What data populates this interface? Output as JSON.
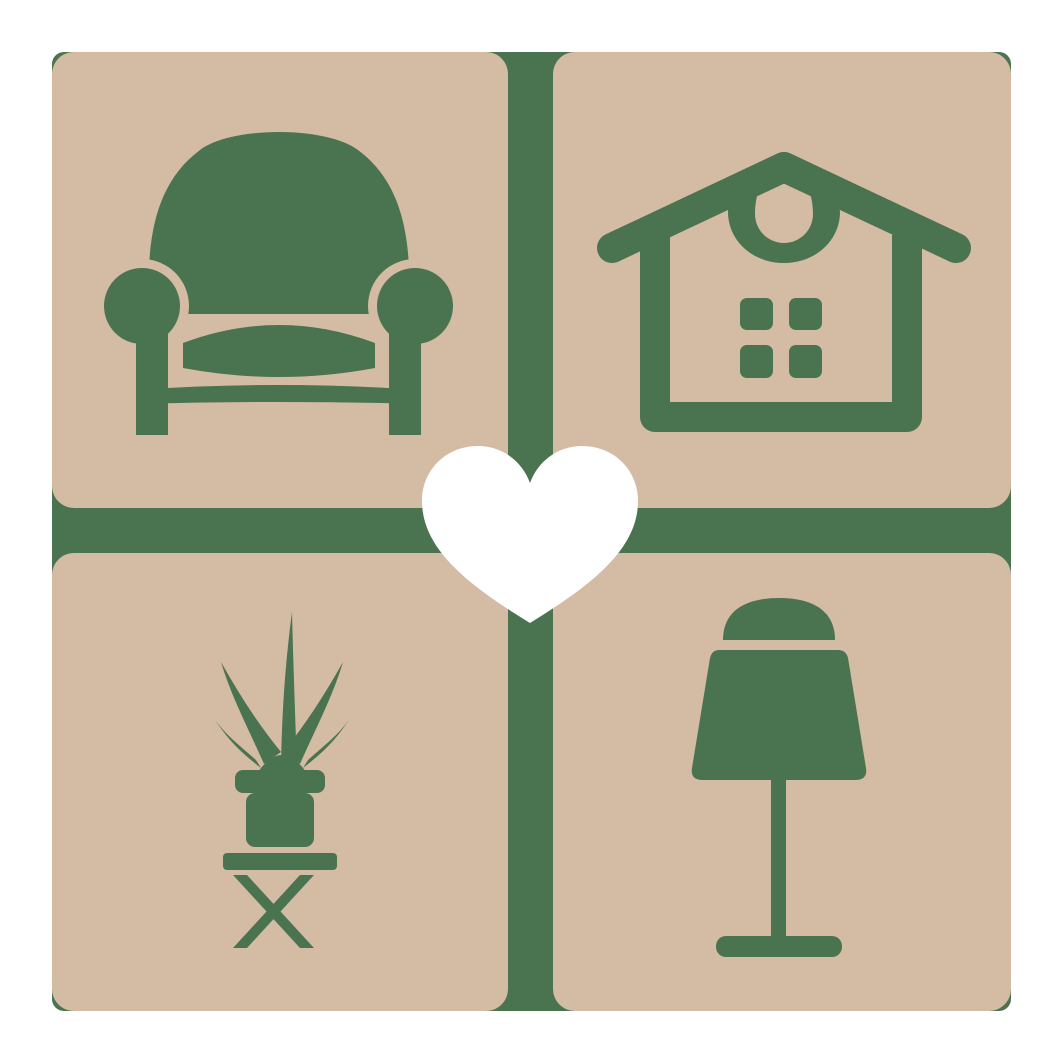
{
  "logo": {
    "description": "home-decor-logo-four-tiles-with-heart",
    "palette": {
      "background": "#ffffff",
      "tile": "#d4bba4",
      "icon_green": "#4a7350",
      "heart": "#ffffff"
    },
    "tiles": [
      {
        "id": "top-left",
        "icon": "armchair-icon"
      },
      {
        "id": "top-right",
        "icon": "house-icon"
      },
      {
        "id": "bottom-left",
        "icon": "potted-plant-icon"
      },
      {
        "id": "bottom-right",
        "icon": "table-lamp-icon"
      }
    ],
    "center": {
      "icon": "heart-icon"
    }
  }
}
